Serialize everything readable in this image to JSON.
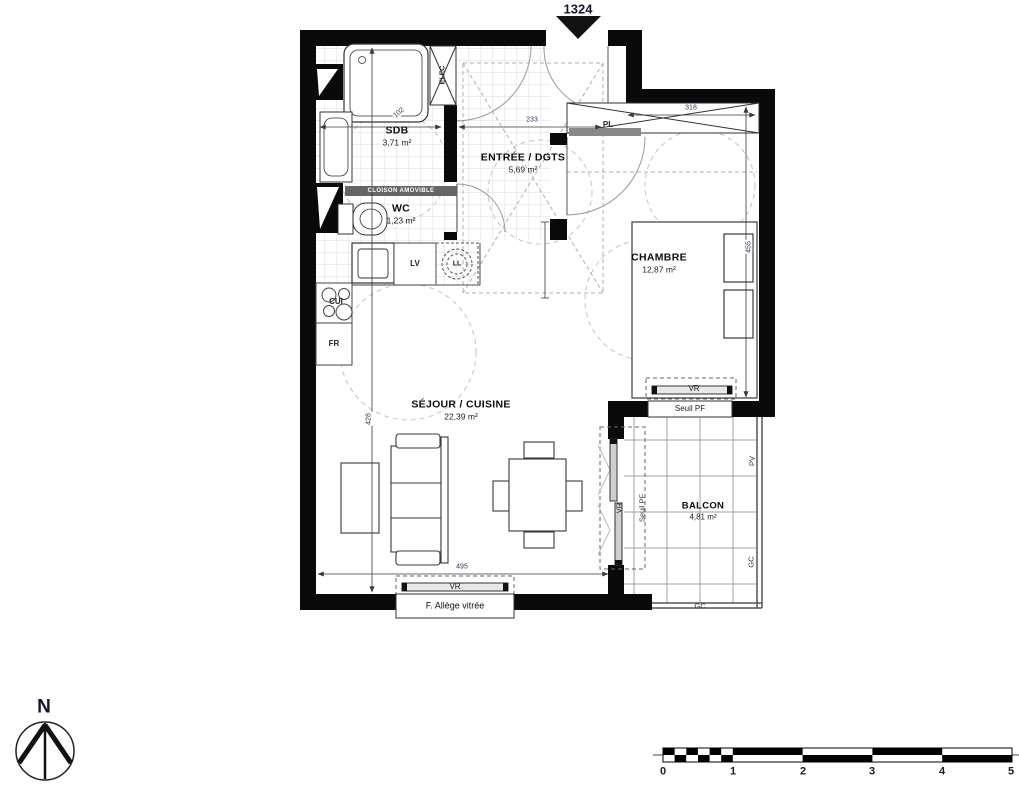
{
  "apartment": {
    "number": "1324"
  },
  "rooms": {
    "sdb": {
      "name": "SDB",
      "area": "3,71 m²"
    },
    "wc": {
      "name": "WC",
      "area": "1,23 m²"
    },
    "entree": {
      "name": "ENTRÉE / DGTS",
      "area": "5,69 m²"
    },
    "chambre": {
      "name": "CHAMBRE",
      "area": "12,87 m²"
    },
    "sejour": {
      "name": "SÉJOUR / CUISINE",
      "area": "22,39 m²"
    },
    "balcon": {
      "name": "BALCON",
      "area": "4,81 m²"
    }
  },
  "equipment": {
    "elec": "ELEC",
    "lave_vaisselle": "LV",
    "lave_linge": "LL",
    "cuisson": "CUI",
    "frigo": "FR",
    "placard": "PL"
  },
  "annotations": {
    "cloison_amovible": "CLOISON AMOVIBLE",
    "volet_roulant": "VR",
    "seuil_pf": "Seuil PF",
    "allege_vitree": "F. Allège vitrée",
    "pv": "PV",
    "gc": "GC"
  },
  "dimensions": {
    "sdb_width": "102",
    "entree_width": "233",
    "placard_width": "318",
    "chambre_depth": "455",
    "sejour_depth": "428",
    "facade_width": "495"
  },
  "compass": {
    "north": "N"
  },
  "scale_bar": {
    "ticks": [
      "0",
      "1",
      "2",
      "3",
      "4",
      "5"
    ]
  }
}
